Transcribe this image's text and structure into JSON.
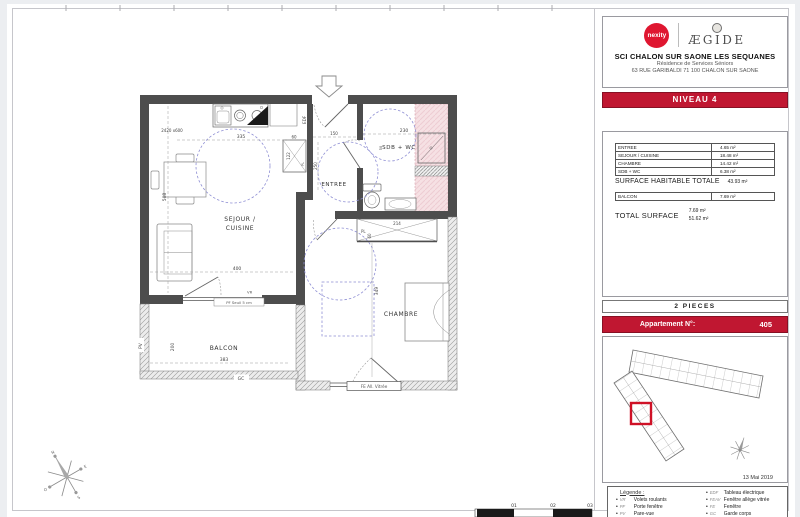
{
  "title_block": {
    "nexity_label": "nexity",
    "aegide_label": "ÆGIDE",
    "project": "SCI CHALON SUR SAONE LES SEQUANES",
    "residence": "Résidence de Services Séniors",
    "address": "63 RUE GARIBALDI 71 100 CHALON SUR SAONE",
    "level": "NIVEAU 4"
  },
  "surface_table": {
    "rows": [
      {
        "label": "ENTREE",
        "value": "4.65 m²"
      },
      {
        "label": "SEJOUR / CUISINE",
        "value": "18.48 m²"
      },
      {
        "label": "CHAMBRE",
        "value": "14.42 m²"
      },
      {
        "label": "SDB + WC",
        "value": "6.38 m²"
      }
    ],
    "habitable_label": "SURFACE HABITABLE TOTALE",
    "habitable_value": "43.93 m²",
    "balcon_label": "BALCON",
    "balcon_value": "7.69 m²",
    "total_label": "TOTAL SURFACE",
    "total_value_line1": "7.69 m²",
    "total_value_line2": "51.62 m²"
  },
  "apartment": {
    "type_label": "2 PIECES",
    "label": "Appartement N°:",
    "number": "405"
  },
  "key_plan": {
    "date": "13 Mai 2019"
  },
  "legend": {
    "title": "Légende :",
    "left": [
      {
        "abbr": "VR",
        "label": "Volets roulants"
      },
      {
        "abbr": "PF",
        "label": "Porte fenêtre"
      },
      {
        "abbr": "PV",
        "label": "Pare-vue"
      }
    ],
    "right": [
      {
        "abbr": "EDF",
        "label": "Tableau électrique"
      },
      {
        "abbr": "FEAV",
        "label": "Fenêtre allège vitrée"
      },
      {
        "abbr": "FE",
        "label": "Fenêtre"
      },
      {
        "abbr": "GC",
        "label": "Garde corps"
      }
    ]
  },
  "plan": {
    "rooms": {
      "sejour_line1": "SEJOUR /",
      "sejour_line2": "CUISINE",
      "entree": "ENTREE",
      "sdb": "SDB + WC",
      "chambre": "CHAMBRE",
      "balcon": "BALCON"
    },
    "annotations": {
      "edf": "EDF",
      "pl": "PL",
      "pv": "PV",
      "gc": "GC",
      "vr": "VR",
      "pf_seuil": "PF  Seuil 5 cm",
      "fe_vitree": "FE  All. Vitrée",
      "counter": "2420 x600"
    },
    "dims": {
      "d335": "335",
      "d508": "508",
      "d150": "150",
      "d230": "230",
      "d250": "250",
      "d50": "50",
      "d400": "400",
      "d383": "383",
      "d200": "200",
      "d349": "349",
      "d214": "214",
      "d60a": "60",
      "d60b": "60",
      "d122": "122"
    }
  },
  "compass": {
    "n": "N",
    "s": "S",
    "e": "E",
    "o": "O"
  },
  "scale_bar": {
    "ticks": [
      "01",
      "02",
      "03"
    ]
  },
  "colors": {
    "accent_red": "#c01731",
    "wall": "#4d4d4d",
    "pink": "#f6e1e4",
    "guide_blue": "#8f8fd4"
  }
}
